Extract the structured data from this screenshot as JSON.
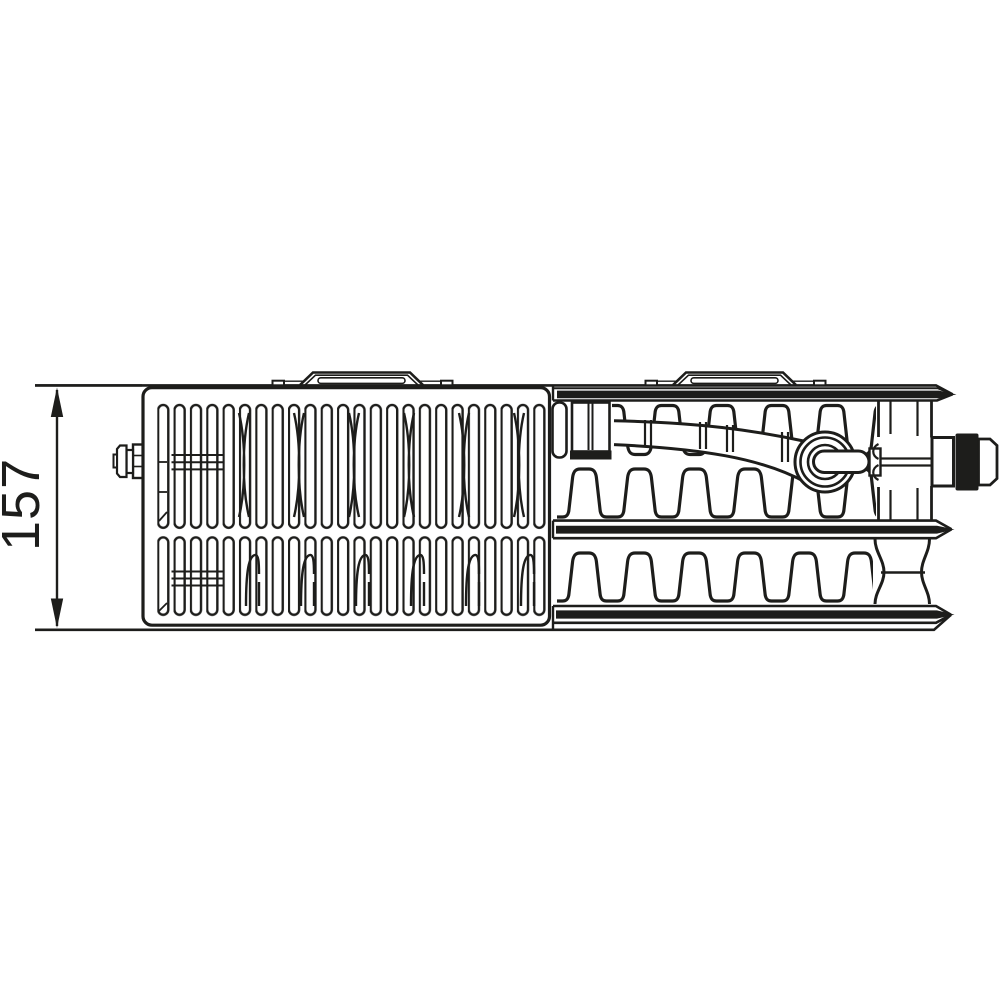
{
  "diagram": {
    "dimension_label": "157",
    "ink_color": "#1d1d1b",
    "background_color": "#ffffff"
  }
}
